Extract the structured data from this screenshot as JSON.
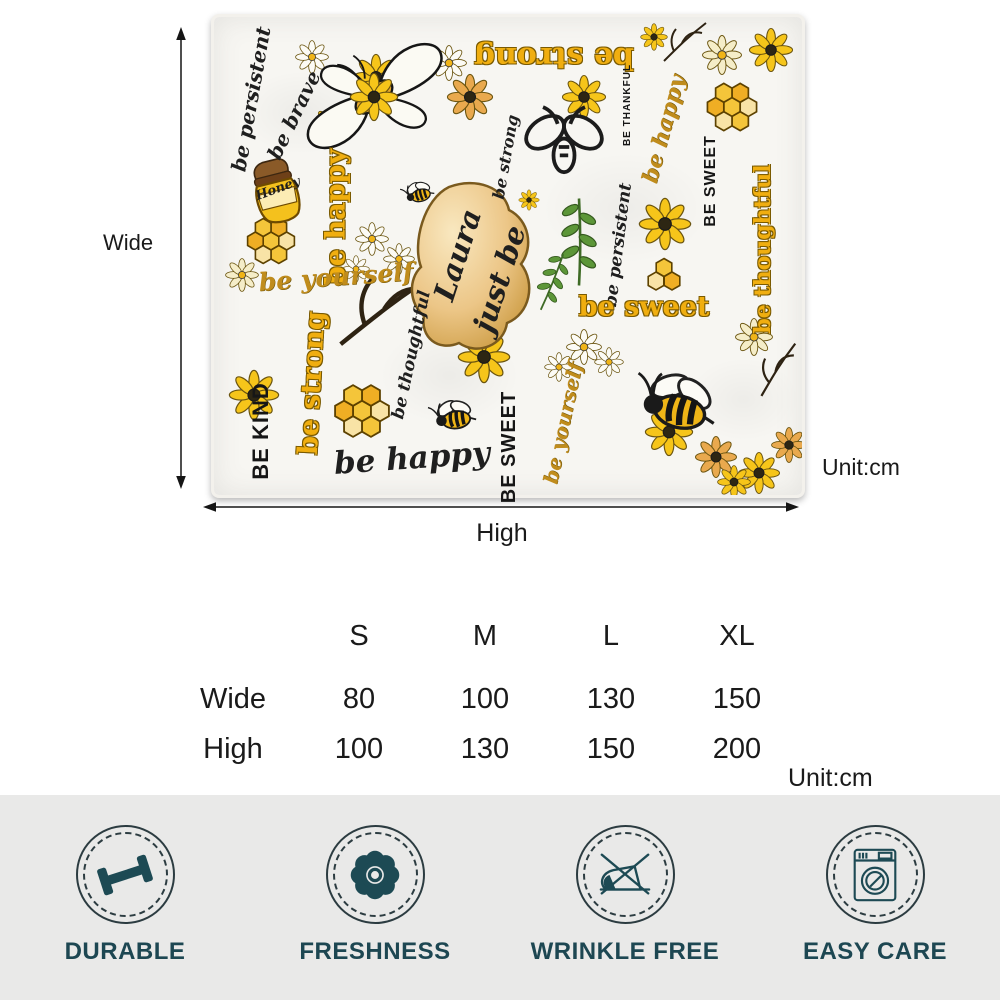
{
  "measurement_diagram": {
    "wide_label": "Wide",
    "high_label": "High",
    "unit_label": "Unit:cm"
  },
  "blanket": {
    "personalized_name": "Laura",
    "motifs": [
      "bee-icon",
      "butterfly-icon",
      "daisy-icon",
      "honeycomb-icon",
      "honey-jar-icon",
      "leaf-sprig-icon",
      "twig-icon",
      "gold-plaque"
    ],
    "words": [
      {
        "text": "be persistent",
        "style": "script-black",
        "x": 37,
        "y": 82,
        "rot": -80,
        "size": 20
      },
      {
        "text": "be brave",
        "style": "script-black",
        "x": 80,
        "y": 98,
        "rot": -64,
        "size": 20
      },
      {
        "text": "be strong",
        "style": "display-gold",
        "x": 340,
        "y": 40,
        "rot": 180,
        "size": 30
      },
      {
        "text": "Honey",
        "style": "script-black",
        "x": 64,
        "y": 172,
        "rot": -20,
        "size": 13
      },
      {
        "text": "be happy",
        "style": "display-gold",
        "x": 122,
        "y": 200,
        "rot": -90,
        "size": 27
      },
      {
        "text": "be yourself",
        "style": "script-gold",
        "x": 122,
        "y": 260,
        "rot": -4,
        "size": 25
      },
      {
        "text": "be strong",
        "style": "display-gold",
        "x": 98,
        "y": 366,
        "rot": -87,
        "size": 27
      },
      {
        "text": "BE KIND",
        "style": "caps-black",
        "x": 47,
        "y": 414,
        "rot": -90,
        "size": 22
      },
      {
        "text": "be happy",
        "style": "script-black",
        "x": 198,
        "y": 442,
        "rot": -4,
        "size": 31
      },
      {
        "text": "be thoughtful",
        "style": "script-black",
        "x": 198,
        "y": 338,
        "rot": -78,
        "size": 17
      },
      {
        "text": "Laura",
        "style": "script-black",
        "x": 244,
        "y": 238,
        "rot": -72,
        "size": 29
      },
      {
        "text": "just be",
        "style": "script-black",
        "x": 286,
        "y": 262,
        "rot": -72,
        "size": 29
      },
      {
        "text": "be strong",
        "style": "script-black",
        "x": 292,
        "y": 140,
        "rot": -80,
        "size": 16
      },
      {
        "text": "be persistent",
        "style": "script-black",
        "x": 405,
        "y": 228,
        "rot": -83,
        "size": 17
      },
      {
        "text": "be sweet",
        "style": "display-gold",
        "x": 430,
        "y": 290,
        "rot": 0,
        "size": 27
      },
      {
        "text": "BE SWEET",
        "style": "caps-black",
        "x": 295,
        "y": 430,
        "rot": -90,
        "size": 20
      },
      {
        "text": "be yourself",
        "style": "script-gold",
        "x": 349,
        "y": 406,
        "rot": -78,
        "size": 20
      },
      {
        "text": "BE THANKFUL",
        "style": "caps-black",
        "x": 414,
        "y": 88,
        "rot": -90,
        "size": 10
      },
      {
        "text": "be happy",
        "style": "script-gold",
        "x": 450,
        "y": 112,
        "rot": -75,
        "size": 22
      },
      {
        "text": "BE SWEET",
        "style": "caps-black",
        "x": 497,
        "y": 164,
        "rot": -90,
        "size": 16
      },
      {
        "text": "be thoughtful",
        "style": "display-gold",
        "x": 549,
        "y": 232,
        "rot": -90,
        "size": 22
      }
    ]
  },
  "size_table": {
    "columns": [
      "S",
      "M",
      "L",
      "XL"
    ],
    "rows": [
      {
        "label": "Wide",
        "values": [
          "80",
          "100",
          "130",
          "150"
        ]
      },
      {
        "label": "High",
        "values": [
          "100",
          "130",
          "150",
          "200"
        ]
      }
    ],
    "unit_label": "Unit:cm"
  },
  "features": [
    {
      "label": "DURABLE",
      "icon": "dumbbell-icon"
    },
    {
      "label": "FRESHNESS",
      "icon": "flower-icon"
    },
    {
      "label": "WRINKLE FREE",
      "icon": "no-iron-icon"
    },
    {
      "label": "EASY CARE",
      "icon": "washing-machine-icon"
    }
  ],
  "colors": {
    "accent_teal": "#1D4A54",
    "gold": "#F0AE10",
    "features_bg": "#E9E9E8"
  }
}
